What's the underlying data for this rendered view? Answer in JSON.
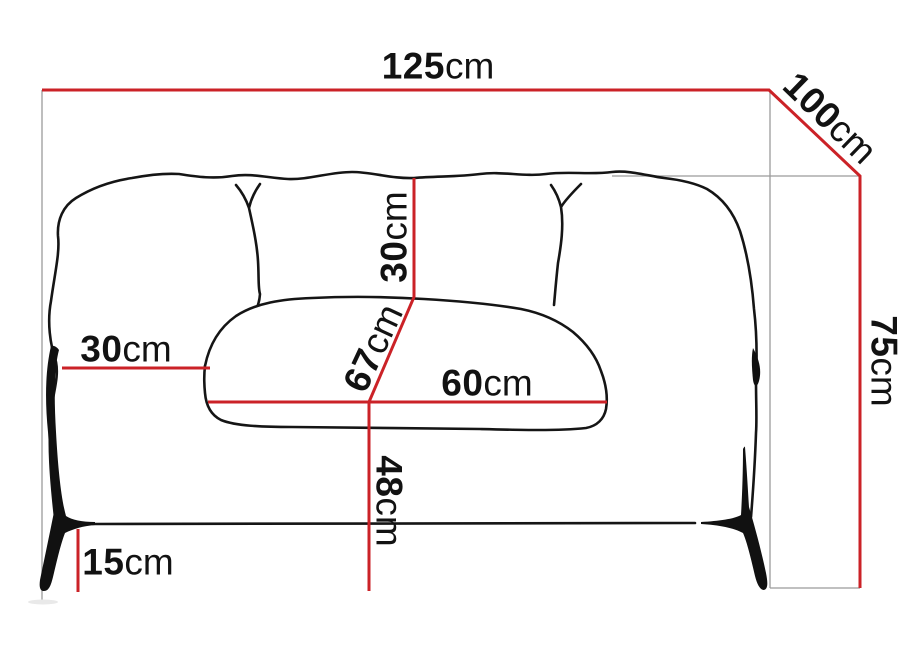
{
  "diagram": {
    "subject": "sofa-front-view-line-drawing",
    "unit": "cm",
    "colors": {
      "dimension_line": "#cb2227",
      "projection_line": "#9b9b9b",
      "outline": "#151515",
      "background": "#ffffff"
    },
    "dimensions": {
      "overall_width": {
        "value": "125",
        "unit": "cm"
      },
      "depth": {
        "value": "100",
        "unit": "cm"
      },
      "overall_height": {
        "value": "75",
        "unit": "cm"
      },
      "backrest_height": {
        "value": "30",
        "unit": "cm"
      },
      "armrest_width": {
        "value": "30",
        "unit": "cm"
      },
      "seat_depth": {
        "value": "67",
        "unit": "cm"
      },
      "seat_width": {
        "value": "60",
        "unit": "cm"
      },
      "seat_height": {
        "value": "48",
        "unit": "cm"
      },
      "leg_height": {
        "value": "15",
        "unit": "cm"
      }
    }
  }
}
